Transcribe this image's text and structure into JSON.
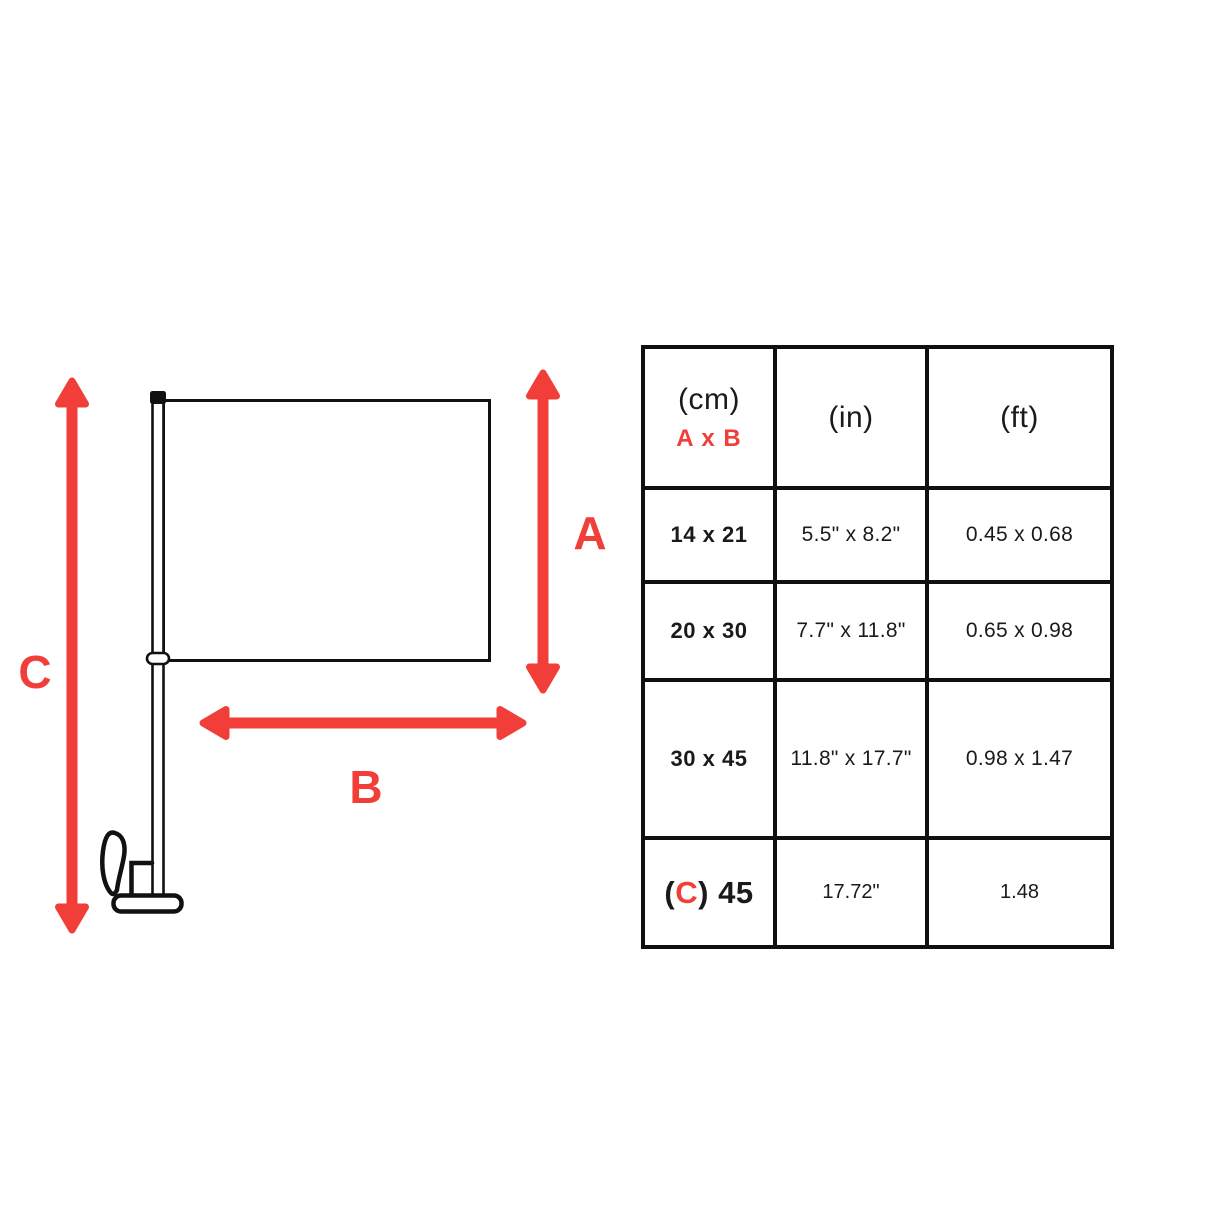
{
  "diagram": {
    "label_a": "A",
    "label_b": "B",
    "label_c": "C",
    "accent_red": "#F13E38",
    "line_color": "#111111"
  },
  "table": {
    "header": {
      "cm": "(cm)",
      "cm_sub": "A x B",
      "in": "(in)",
      "ft": "(ft)"
    },
    "rows": [
      {
        "cm": "14 x 21",
        "inches": "5.5\" x 8.2\"",
        "feet": "0.45 x 0.68"
      },
      {
        "cm": "20 x 30",
        "inches": "7.7\" x 11.8\"",
        "feet": "0.65 x 0.98"
      },
      {
        "cm": "30 x 45",
        "inches": "11.8\" x 17.7\"",
        "feet": "0.98 x 1.47"
      }
    ],
    "last_row": {
      "open": "(",
      "c": "C",
      "close_value": ") 45",
      "inches": "17.72\"",
      "feet": "1.48"
    }
  }
}
